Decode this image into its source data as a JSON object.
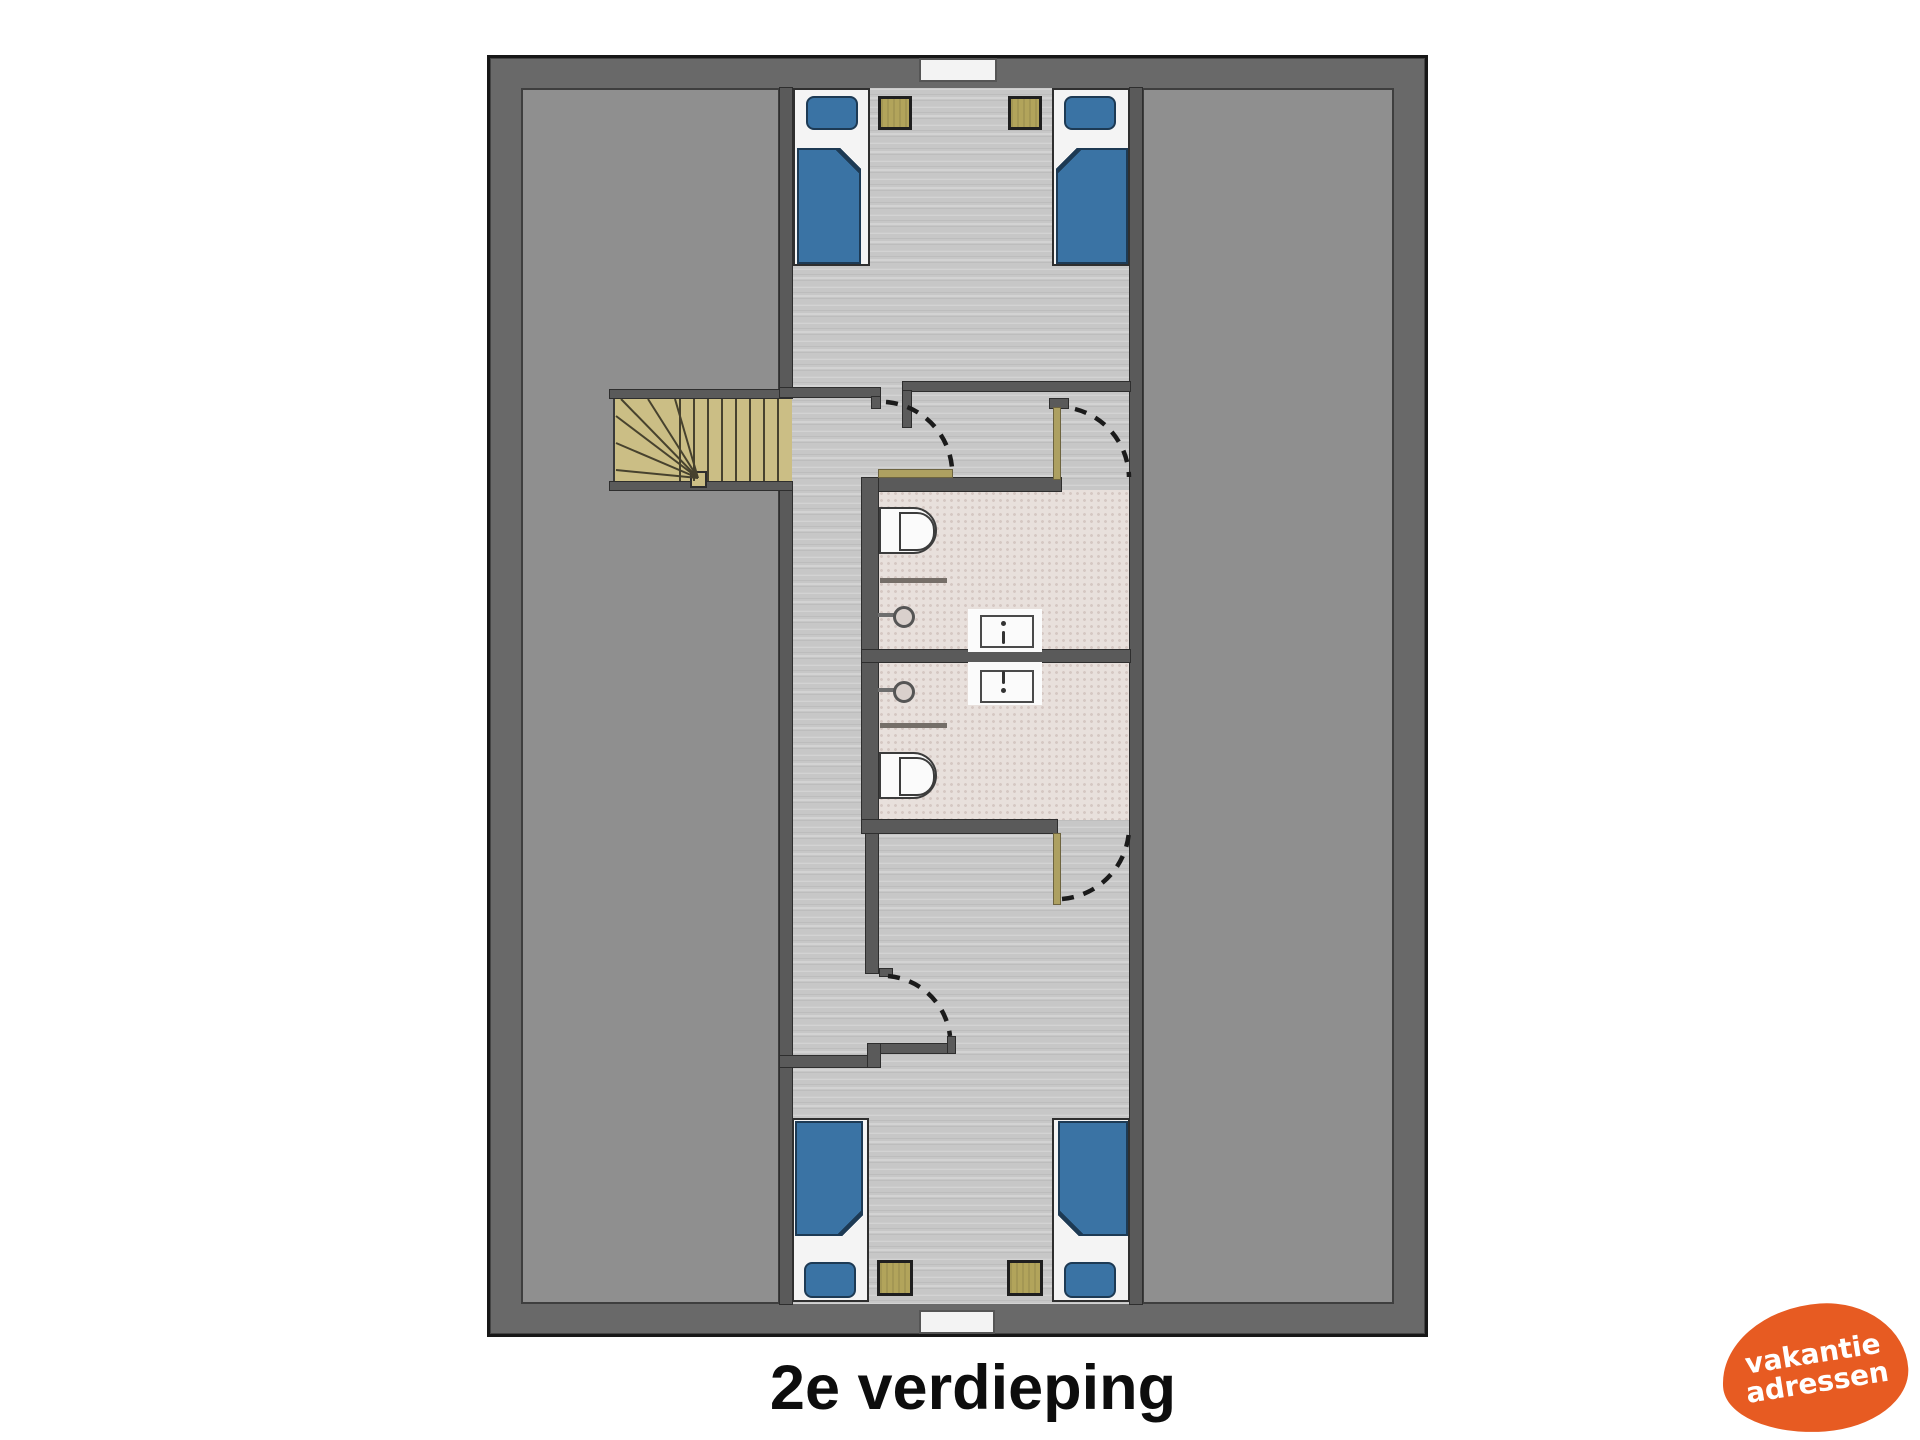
{
  "title": {
    "text": "2e verdieping"
  },
  "logo": {
    "line1": "vakantie",
    "line2": "adressen"
  },
  "palette": {
    "page_bg": "#ffffff",
    "outer_wall": "#696969",
    "side_room": "#8f8f8f",
    "side_room_line": "#3e3e3e",
    "hall_floor": "#c7c7c7",
    "bath_floor": "#e8e0dc",
    "bath_dot": "#d5c8c3",
    "partition": "#5a5a5a",
    "partition_line": "#2e2e2e",
    "stairs": "#cbbe85",
    "stair_line": "#47422e",
    "bed_blue": "#3a73a4",
    "bed_line": "#1d3a54",
    "mattress": "#f4f4f4",
    "nightstand": "#b2a45b",
    "door_leaf": "#ada061",
    "arc": "#1b1b1b",
    "fixture_white": "#fbfbfb",
    "fixture_line": "#3c3c3c",
    "title_color": "#0d0d0d",
    "logo_bg": "#e75b22",
    "logo_text": "#ffffff"
  },
  "legend_symbols": [
    "bed",
    "pillow",
    "duvet",
    "nightstand",
    "toilet",
    "washbasin",
    "vanity-sink",
    "staircase",
    "door-swing-arc",
    "door-leaf",
    "window",
    "wall"
  ]
}
